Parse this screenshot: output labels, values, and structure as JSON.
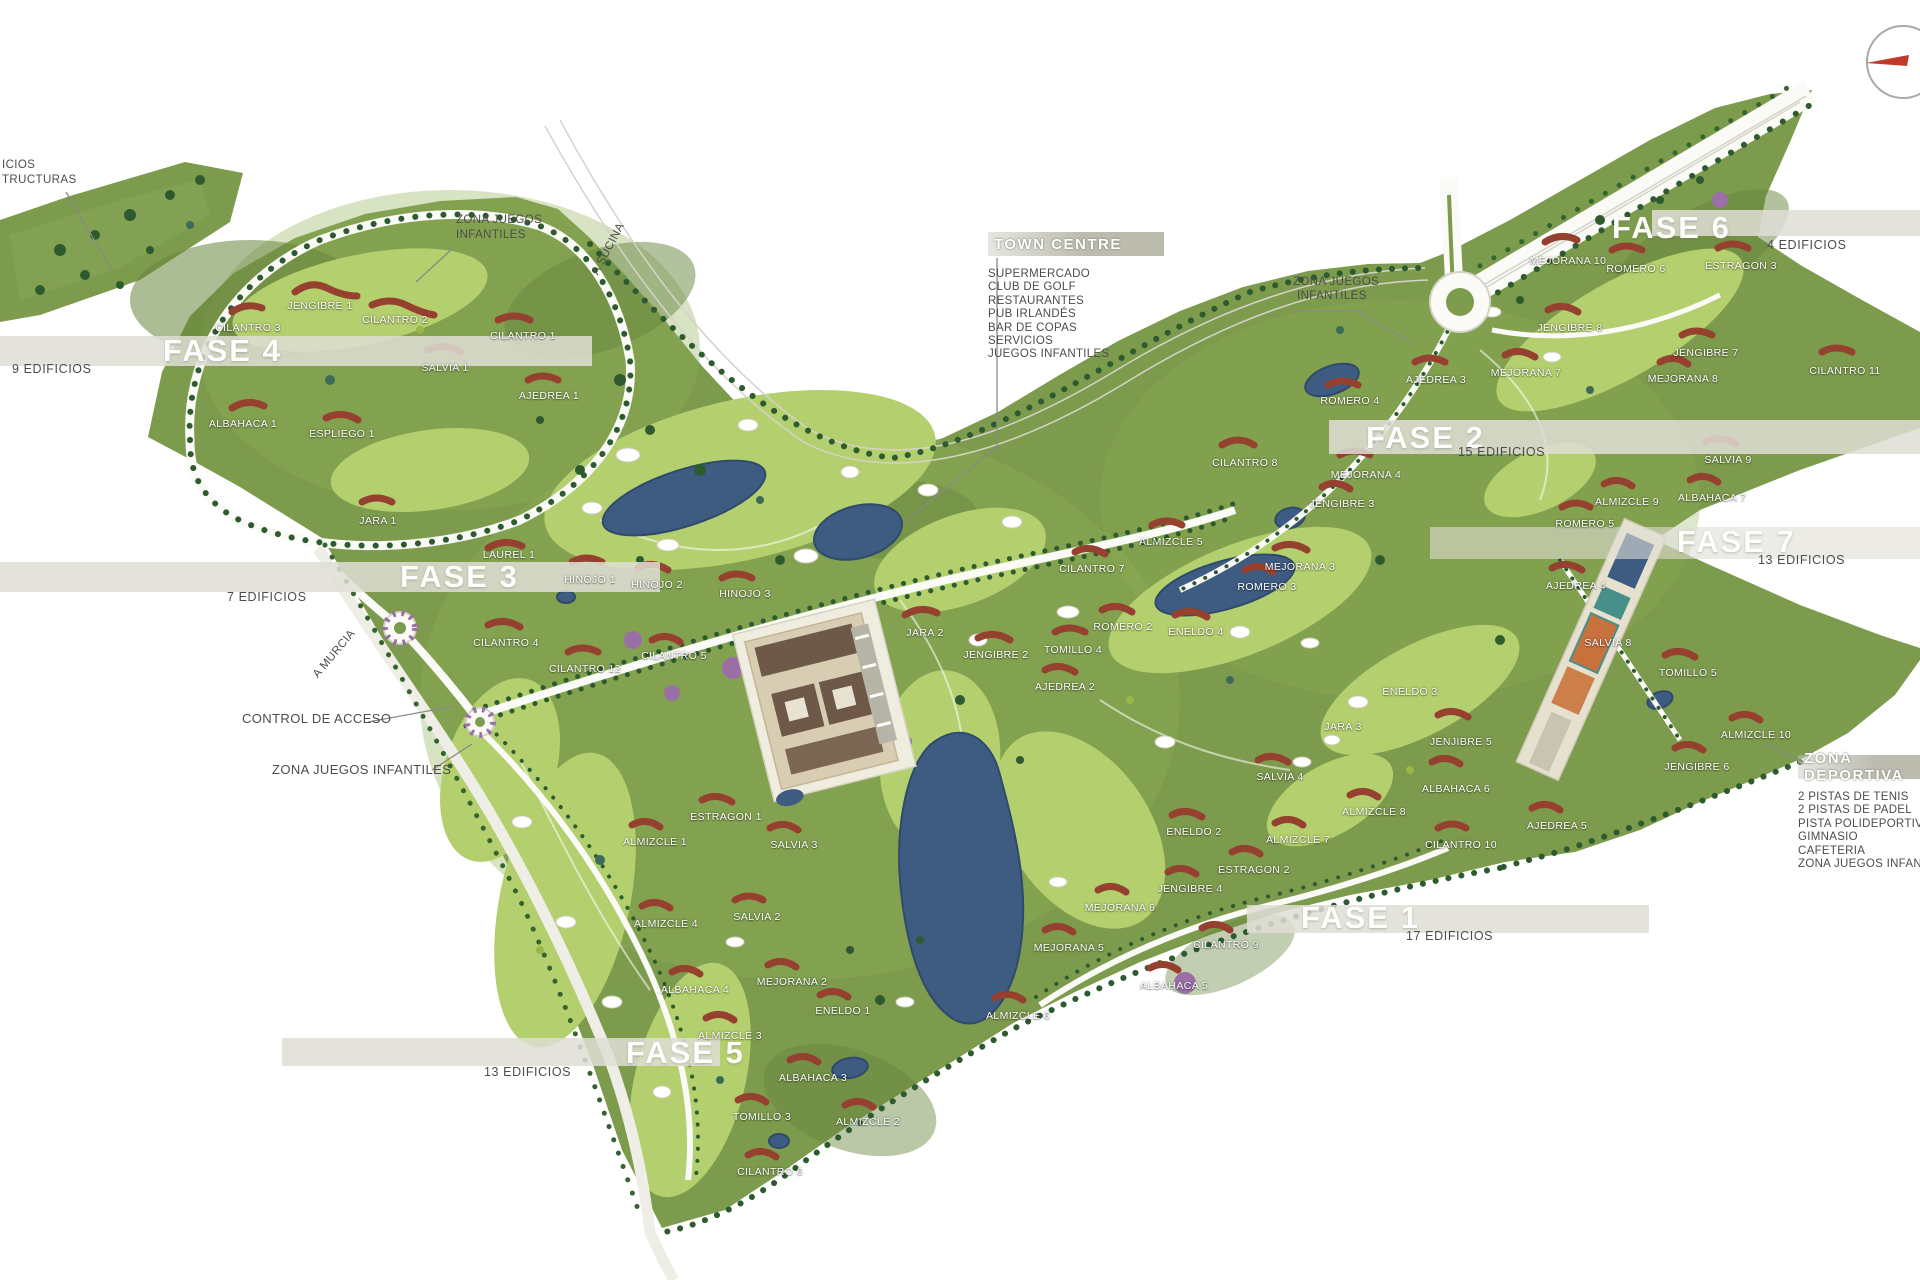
{
  "colors": {
    "terrain_green": "#7d9b4d",
    "fairway_green": "#b4cf6d",
    "dark_tree_green": "#2d5b2f",
    "water_blue": "#3e5c82",
    "building_red": "#96402f",
    "flower_purple": "#9a6fa8",
    "band_gray": "#dfded5",
    "annotation_gray": "#4c4c4c",
    "compass_red": "#c0392b",
    "road_white": "#fafaf6"
  },
  "compass": {
    "icon": "north-arrow-compass"
  },
  "phases": [
    {
      "id": "fase4",
      "label": "FASE 4",
      "edificios": "9 EDIFICIOS",
      "band": [
        0,
        336,
        592,
        30
      ],
      "lx": 163,
      "ly": 351,
      "ex": 12,
      "ey": 369
    },
    {
      "id": "fase3",
      "label": "FASE 3",
      "edificios": "7 EDIFICIOS",
      "band": [
        0,
        562,
        660,
        30
      ],
      "lx": 400,
      "ly": 577,
      "ex": 227,
      "ey": 597
    },
    {
      "id": "fase2",
      "label": "FASE 2",
      "edificios": "15 EDIFICIOS",
      "band": [
        1329,
        420,
        591,
        34
      ],
      "lx": 1366,
      "ly": 438,
      "ex": 1458,
      "ey": 452
    },
    {
      "id": "fase6",
      "label": "FASE 6",
      "edificios": "4 EDIFICIOS",
      "band": [
        1652,
        210,
        268,
        26
      ],
      "lx": 1612,
      "ly": 228,
      "ex": 1767,
      "ey": 245
    },
    {
      "id": "fase7",
      "label": "FASE 7",
      "edificios": "13 EDIFICIOS",
      "band": [
        1430,
        527,
        490,
        32
      ],
      "lx": 1677,
      "ly": 542,
      "ex": 1758,
      "ey": 560
    },
    {
      "id": "fase1",
      "label": "FASE 1",
      "edificios": "17 EDIFICIOS",
      "band": [
        1247,
        905,
        402,
        28
      ],
      "lx": 1301,
      "ly": 918,
      "ex": 1406,
      "ey": 936
    },
    {
      "id": "fase5",
      "label": "FASE 5",
      "edificios": "13 EDIFICIOS",
      "band": [
        282,
        1038,
        438,
        28
      ],
      "lx": 626,
      "ly": 1053,
      "ex": 484,
      "ey": 1072
    }
  ],
  "legends": {
    "town_centre": {
      "title": "TOWN CENTRE",
      "x": 988,
      "y": 232,
      "w": 164,
      "items": [
        "SUPERMERCADO",
        "CLUB DE GOLF",
        "RESTAURANTES",
        "PUB IRLANDÉS",
        "BAR DE COPAS",
        "SERVICIOS",
        "JUEGOS INFANTILES"
      ]
    },
    "zona_deportiva": {
      "title": "ZONA DEPORTIVA",
      "x": 1798,
      "y": 755,
      "w": 130,
      "items": [
        "2 PISTAS DE TENIS",
        "2 PISTAS DE PADEL",
        "PISTA POLIDEPORTIVA",
        "GIMNASIO",
        "CAFETERIA",
        "ZONA JUEGOS INFANTILES"
      ]
    }
  },
  "street_labels": [
    [
      "JENGIBRE 1",
      320,
      306
    ],
    [
      "CILANTRO 2",
      395,
      320
    ],
    [
      "CILANTRO 3",
      248,
      328
    ],
    [
      "CILANTRO 1",
      523,
      336
    ],
    [
      "SALVIA 1",
      445,
      368
    ],
    [
      "AJEDREA 1",
      549,
      396
    ],
    [
      "ALBAHACA 1",
      243,
      424
    ],
    [
      "ESPLIEGO 1",
      342,
      434
    ],
    [
      "JARA 1",
      378,
      521
    ],
    [
      "LAUREL 1",
      509,
      555
    ],
    [
      "HINOJO 1",
      590,
      580
    ],
    [
      "HINOJO 2",
      657,
      585
    ],
    [
      "HINOJO 3",
      745,
      594
    ],
    [
      "CILANTRO 4",
      506,
      643
    ],
    [
      "CILANTRO 12",
      585,
      669
    ],
    [
      "CILANTRO 5",
      674,
      656
    ],
    [
      "JARA 2",
      925,
      633
    ],
    [
      "JENGIBRE 2",
      996,
      655
    ],
    [
      "TOMILLO 4",
      1073,
      650
    ],
    [
      "ROMERO 2",
      1123,
      627
    ],
    [
      "ENELDO 4",
      1196,
      632
    ],
    [
      "AJEDREA 2",
      1065,
      687
    ],
    [
      "CILANTRO 8",
      1245,
      463
    ],
    [
      "ALMIZCLE 5",
      1171,
      542
    ],
    [
      "CILANTRO 7",
      1092,
      569
    ],
    [
      "MEJORANA 3",
      1300,
      567
    ],
    [
      "ROMERO 3",
      1267,
      587
    ],
    [
      "MEJORANA 4",
      1366,
      475
    ],
    [
      "JENGIBRE 3",
      1342,
      504
    ],
    [
      "ROMERO 4",
      1350,
      401
    ],
    [
      "AJEDREA 3",
      1436,
      380
    ],
    [
      "MEJORANA 10",
      1568,
      261
    ],
    [
      "ROMERO 6",
      1636,
      269
    ],
    [
      "ESTRAGON 3",
      1741,
      266
    ],
    [
      "JENGIBRE 8",
      1570,
      328
    ],
    [
      "MEJORANA 7",
      1526,
      373
    ],
    [
      "JENGIBRE 7",
      1706,
      353
    ],
    [
      "MEJORANA 8",
      1683,
      379
    ],
    [
      "CILANTRO 11",
      1845,
      371
    ],
    [
      "SALVIA 9",
      1728,
      460
    ],
    [
      "ALBAHACA 7",
      1712,
      498
    ],
    [
      "ALMIZCLE 9",
      1627,
      502
    ],
    [
      "ROMERO 5",
      1585,
      524
    ],
    [
      "AJEDREA 4",
      1576,
      586
    ],
    [
      "SALVIA 8",
      1608,
      643
    ],
    [
      "TOMILLO 5",
      1688,
      673
    ],
    [
      "ALMIZCLE 10",
      1756,
      735
    ],
    [
      "JENGIBRE 6",
      1697,
      767
    ],
    [
      "ENELDO 3",
      1410,
      692
    ],
    [
      "JARA 3",
      1343,
      727
    ],
    [
      "JENJIBRE 5",
      1461,
      742
    ],
    [
      "ALBAHACA 6",
      1456,
      789
    ],
    [
      "AJEDREA 5",
      1557,
      826
    ],
    [
      "CILANTRO 10",
      1461,
      845
    ],
    [
      "SALVIA 4",
      1280,
      777
    ],
    [
      "ENELDO 2",
      1194,
      832
    ],
    [
      "ALMIZCLE 7",
      1298,
      840
    ],
    [
      "ALMIZCLE 8",
      1374,
      812
    ],
    [
      "ESTRAGON 2",
      1254,
      870
    ],
    [
      "JENGIBRE 4",
      1190,
      889
    ],
    [
      "MEJORANA 6",
      1120,
      908
    ],
    [
      "MEJORANA 5",
      1069,
      948
    ],
    [
      "CILANTRO 9",
      1226,
      945
    ],
    [
      "ALBAHACA 5",
      1174,
      986
    ],
    [
      "ALMIZCLE 6",
      1018,
      1016
    ],
    [
      "ESTRAGON 1",
      726,
      817
    ],
    [
      "ALMIZCLE 1",
      655,
      842
    ],
    [
      "SALVIA 3",
      794,
      845
    ],
    [
      "SALVIA 2",
      757,
      917
    ],
    [
      "ALMIZCLE 4",
      666,
      924
    ],
    [
      "ALBAHACA 4",
      695,
      990
    ],
    [
      "MEJORANA 2",
      792,
      982
    ],
    [
      "ENELDO 1",
      843,
      1011
    ],
    [
      "ALMIZCLE 3",
      730,
      1036
    ],
    [
      "ALBAHACA 3",
      813,
      1078
    ],
    [
      "TOMILLO 3",
      762,
      1117
    ],
    [
      "ALMIZCLE 2",
      868,
      1122
    ],
    [
      "CILANTRO 6",
      770,
      1172
    ]
  ],
  "annotations": [
    {
      "t": "ICIOS",
      "x": 2,
      "y": 166
    },
    {
      "t": "TRUCTURAS",
      "x": 2,
      "y": 181
    },
    {
      "t": "ZONA JUEGOS",
      "x": 456,
      "y": 221
    },
    {
      "t": "INFANTILES",
      "x": 456,
      "y": 236
    },
    {
      "t": "A SUCINA",
      "x": 580,
      "y": 250,
      "r": -62
    },
    {
      "t": "ZONA JUEGOS",
      "x": 1293,
      "y": 283
    },
    {
      "t": "INFANTILES",
      "x": 1297,
      "y": 297
    },
    {
      "t": "A MURCIA",
      "x": 305,
      "y": 655,
      "r": -50
    },
    {
      "t": "CONTROL DE ACCESO",
      "x": 242,
      "y": 718,
      "s": 13
    },
    {
      "t": "ZONA JUEGOS INFANTILES",
      "x": 272,
      "y": 769,
      "s": 13
    }
  ]
}
